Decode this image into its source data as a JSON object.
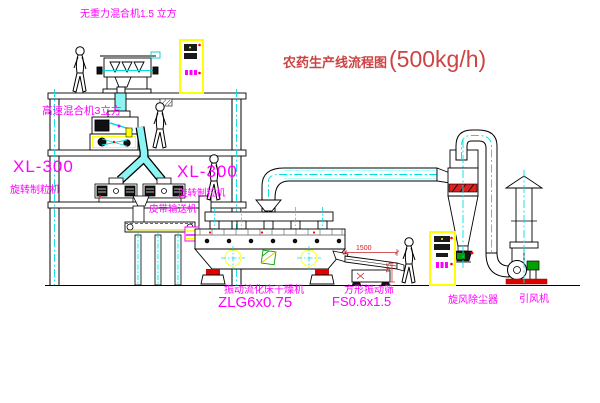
{
  "title": {
    "name": "农药生产线流程图",
    "capacity": "(500kg/h)"
  },
  "labels": {
    "gravity_mixer": "无重力混合机1.5 立方",
    "high_speed_mixer": "高速混合机3立方",
    "granulator_left": {
      "model": "XL-300",
      "name": "旋转制粒机"
    },
    "granulator_right": {
      "model": "XL-300",
      "name": "旋转制粒机"
    },
    "belt_conveyor": "皮带输送机",
    "dryer": {
      "name": "振动流化床干燥机",
      "model": "ZLG6x0.75"
    },
    "sieve": {
      "name": "方形振动筛",
      "model": "FS0.6x1.5"
    },
    "cyclone": "旋风除尘器",
    "fan": "引风机"
  },
  "dimensions": {
    "sieve_length": "1500",
    "sieve_height": "541"
  },
  "colors": {
    "label_magenta": "#ff00ff",
    "title_red": "#cc4444",
    "dimension_red": "#cc2222",
    "cabinet_yellow": "#ffff00",
    "centerline_cyan": "#00e0e0",
    "accent_red": "#ff0000",
    "motor_green": "#00a000",
    "line_black": "#000000",
    "background": "#ffffff"
  }
}
